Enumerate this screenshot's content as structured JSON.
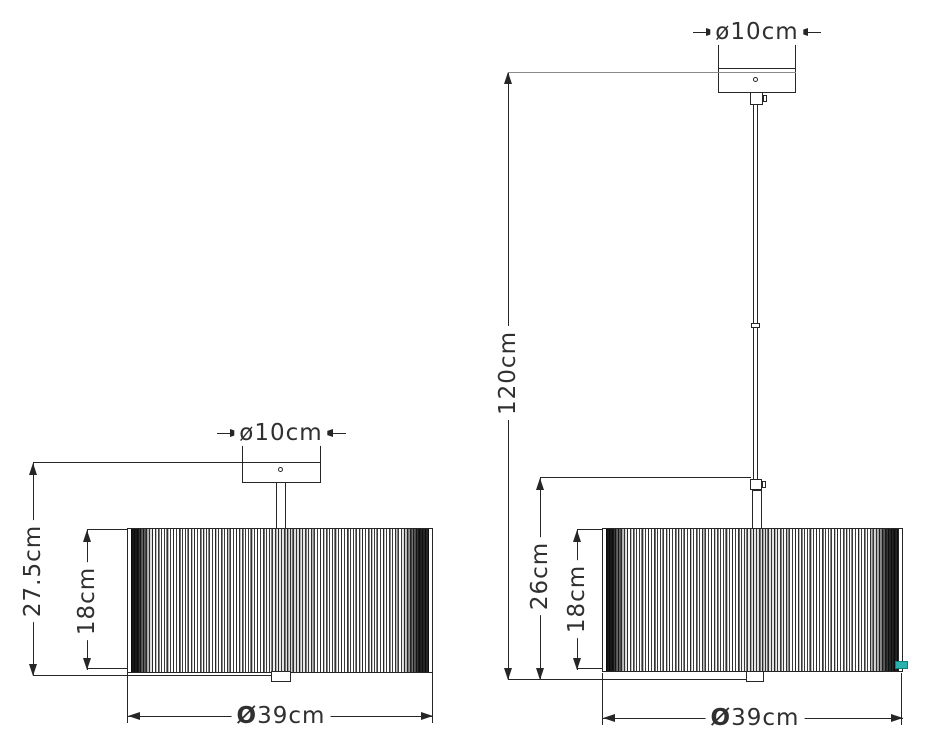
{
  "colors": {
    "ink": "#262626",
    "extension_line": "#8a8a8a",
    "shade_tag": "#29b1ab",
    "background": "#ffffff"
  },
  "views": [
    {
      "name": "semi-flush ceiling lamp",
      "dimensions": {
        "canopy_diameter": "ø10cm",
        "overall_height": "27.5cm",
        "shade_height": "18cm",
        "shade_diameter": "Ø39cm"
      }
    },
    {
      "name": "pendant lamp",
      "dimensions": {
        "canopy_diameter": "ø10cm",
        "overall_height": "120cm",
        "stem_to_shade_height": "26cm",
        "shade_height": "18cm",
        "shade_diameter": "Ø39cm"
      }
    }
  ]
}
